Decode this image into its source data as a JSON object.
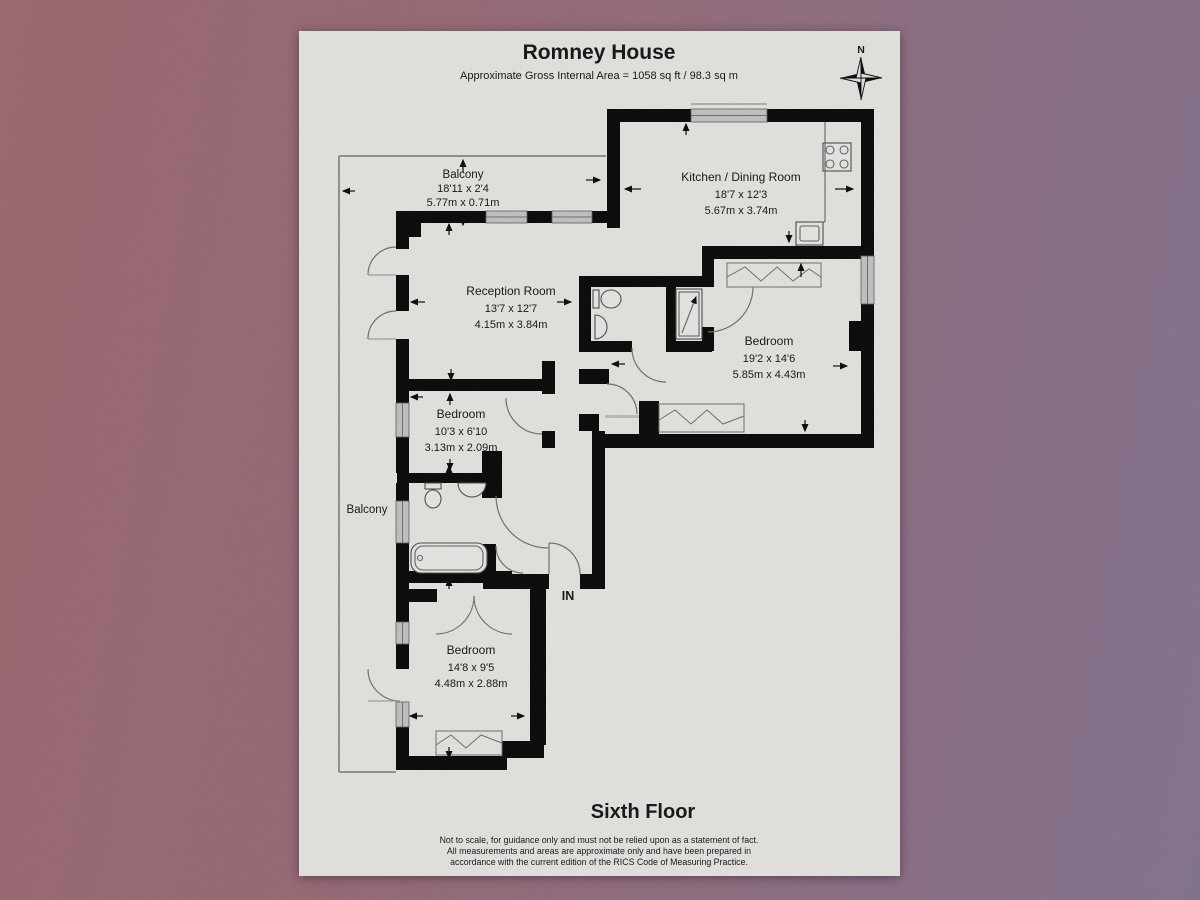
{
  "header": {
    "title": "Romney House",
    "subtitle": "Approximate Gross Internal Area = 1058 sq ft / 98.3 sq m"
  },
  "compass": {
    "label": "N"
  },
  "rooms": [
    {
      "name": "Balcony",
      "imperial": "18'11 x 2'4",
      "metric": "5.77m x 0.71m"
    },
    {
      "name": "Kitchen / Dining Room",
      "imperial": "18'7 x 12'3",
      "metric": "5.67m x 3.74m"
    },
    {
      "name": "Reception Room",
      "imperial": "13'7 x 12'7",
      "metric": "4.15m x 3.84m"
    },
    {
      "name": "Bedroom",
      "imperial": "19'2 x 14'6",
      "metric": "5.85m x 4.43m"
    },
    {
      "name": "Bedroom",
      "imperial": "10'3 x 6'10",
      "metric": "3.13m x 2.09m"
    },
    {
      "name": "Bedroom",
      "imperial": "14'8 x 9'5",
      "metric": "4.48m x 2.88m"
    },
    {
      "name": "Balcony"
    }
  ],
  "entrance": {
    "label": "IN"
  },
  "footer": {
    "floor": "Sixth Floor",
    "disclaimer_lines": [
      "Not to scale, for guidance only and must not be relied upon as a statement of fact.",
      "All measurements and areas are approximate only and have been prepared in",
      "accordance with the current edition of the RICS Code of Measuring Practice."
    ]
  },
  "colors": {
    "wall": "#0f0f0f",
    "window_fill": "#cdcdcd",
    "page": "#f0efec",
    "background_left": "#a6717a",
    "background_right": "#8d7d99",
    "line": "#777777",
    "text": "#1c1c1c"
  }
}
